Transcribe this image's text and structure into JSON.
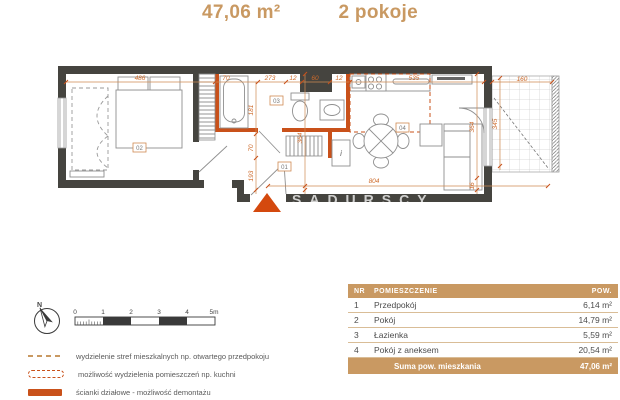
{
  "title": {
    "area": "47,06 m²",
    "rooms": "2 pokoje"
  },
  "plan": {
    "room_labels": [
      "01",
      "02",
      "03",
      "04"
    ],
    "dims_top": [
      "486",
      "70",
      "273",
      "12",
      "60",
      "12",
      "535",
      "160"
    ],
    "dims_left_chain": [
      "181",
      "70",
      "193"
    ],
    "dim_mid_vertical": "364",
    "dims_right_chain": [
      "364",
      "16"
    ],
    "dim_balcony_vertical": "345",
    "dim_bottom": "804",
    "cabinet_label": "i",
    "watermark": "SADURSCY"
  },
  "compass": {
    "north": "N"
  },
  "scalebar": {
    "ticks": [
      "0",
      "1",
      "2",
      "3",
      "4",
      "5m"
    ]
  },
  "legend": {
    "items": [
      {
        "swatch": "dashed-line",
        "label": "wydzielenie stref mieszkalnych np. otwartego przedpokoju"
      },
      {
        "swatch": "dashed-outline",
        "label": "możliwość wydzielenia pomieszczeń np. kuchni"
      },
      {
        "swatch": "solid",
        "label": "ścianki działowe - możliwość demontażu"
      }
    ]
  },
  "table": {
    "headers": [
      "NR",
      "POMIESZCZENIE",
      "POW."
    ],
    "rows": [
      {
        "nr": "1",
        "name": "Przedpokój",
        "area": "6,14 m²"
      },
      {
        "nr": "2",
        "name": "Pokój",
        "area": "14,79 m²"
      },
      {
        "nr": "3",
        "name": "Łazienka",
        "area": "5,59 m²"
      },
      {
        "nr": "4",
        "name": "Pokój z aneksem",
        "area": "20,54 m²"
      }
    ],
    "sum_label": "Suma pow. mieszkania",
    "sum_value": "47,06 m²"
  },
  "colors": {
    "accent_tan": "#C99962",
    "accent_orange": "#C9511A",
    "wall_dark": "#45443F",
    "dim_orange": "#CE6B2B"
  }
}
